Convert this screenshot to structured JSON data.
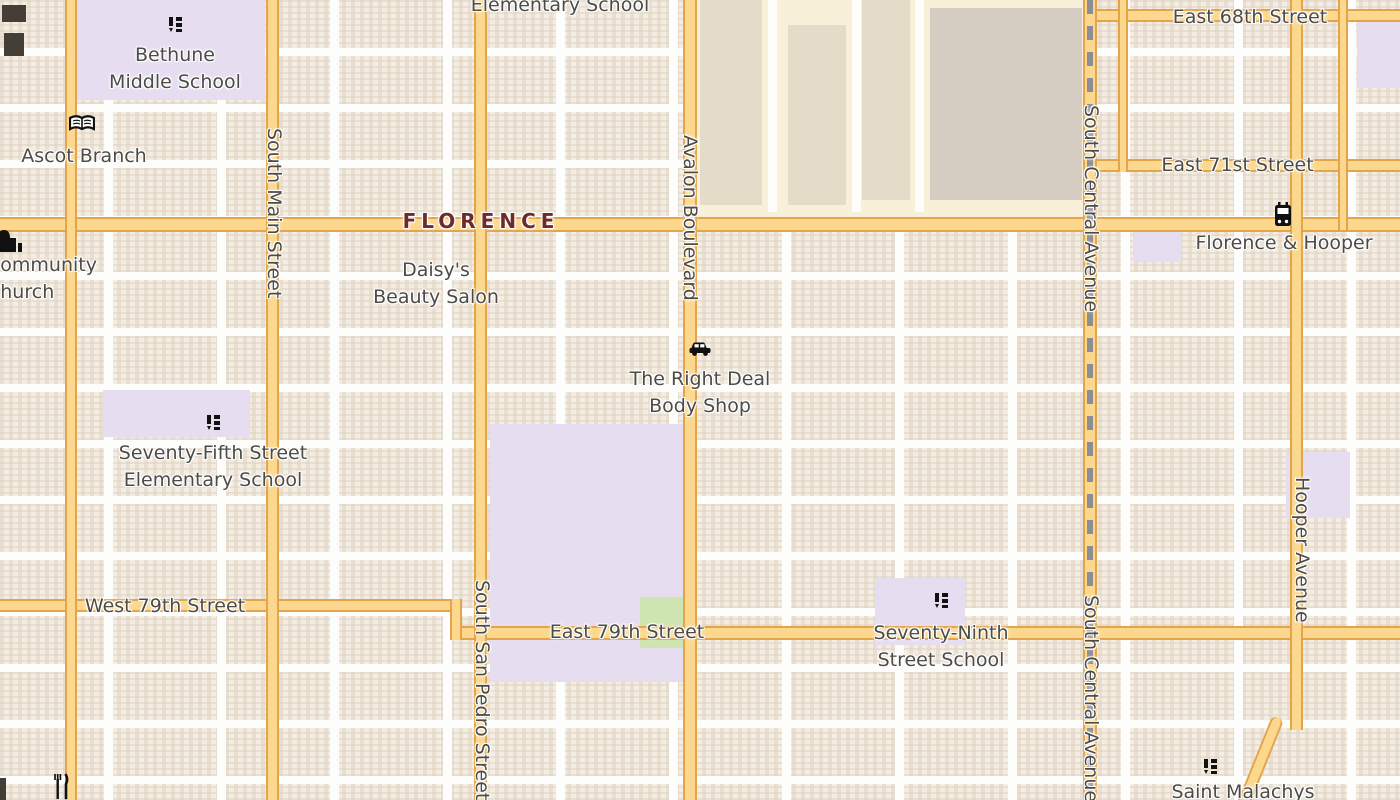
{
  "place": {
    "florence": "FLORENCE"
  },
  "streets": {
    "east_68th": "East 68th Street",
    "east_71st": "East 71st Street",
    "west_79th": "West 79th Street",
    "east_79th": "East 79th Street",
    "south_main": "South Main Street",
    "south_san_pedro": "South San Pedro Street",
    "avalon": "Avalon Boulevard",
    "south_central_top": "South Central Avenue",
    "south_central_bottom": "South Central Avenue",
    "hooper": "Hooper Avenue"
  },
  "pois": {
    "elementary_partial": "Elementary School",
    "bethune_l1": "Bethune",
    "bethune_l2": "Middle School",
    "ascot_branch": "Ascot Branch",
    "community_l1": "Community",
    "community_l2": "Church",
    "daisys_l1": "Daisy's",
    "daisys_l2": "Beauty Salon",
    "body_shop_l1": "The Right Deal",
    "body_shop_l2": "Body Shop",
    "s75_l1": "Seventy-Fifth Street",
    "s75_l2": "Elementary School",
    "s79_l1": "Seventy-Ninth",
    "s79_l2": "Street School",
    "florence_hooper": "Florence & Hooper",
    "saint_malachys": "Saint Malachys"
  },
  "icons": {
    "school": "school-icon",
    "library_book": "book-icon",
    "bus_stop": "bus-icon",
    "car_repair": "car-icon",
    "church": "church-icon",
    "restaurant": "fork-knife-icon"
  },
  "colors": {
    "road_fill": "#fbd88e",
    "road_casing": "#e3a44a",
    "railway": "#8d8d96",
    "school_area": "#e6ddf1",
    "park": "#cee5b2",
    "commercial_area": "#f8f0d8",
    "place_text": "#6d2b2b",
    "label_text": "#4c4b47",
    "icon": "#111111"
  }
}
